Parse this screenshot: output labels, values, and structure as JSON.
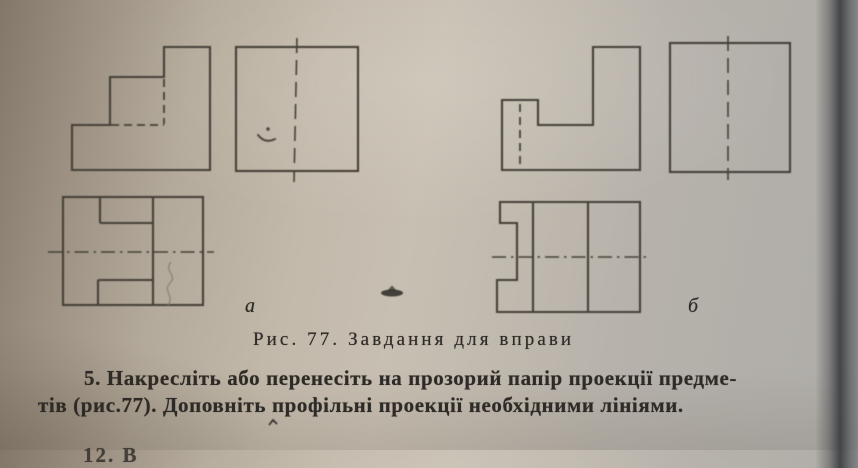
{
  "document": {
    "caption": "Рис. 77. Завдання для вправи",
    "figure_number": "77",
    "labels": {
      "left_group": "а",
      "right_group": "б"
    },
    "exercise": {
      "line1": "5. Накресліть або перенесіть на прозорий папір проекції предме-",
      "line2": "тів (рис.77). Доповніть профільні проекції необхідними лініями."
    },
    "next_line_partial": "12. В",
    "figure_views": [
      "front-view-a",
      "side-view-a",
      "top-view-a",
      "front-view-b",
      "side-view-b",
      "top-view-b"
    ],
    "colors": {
      "ink": "#454039",
      "text": "#2e2a26",
      "paper-light": "#c7bfb2",
      "paper-dark": "#83776a",
      "shadow-band": "#53565a"
    }
  }
}
